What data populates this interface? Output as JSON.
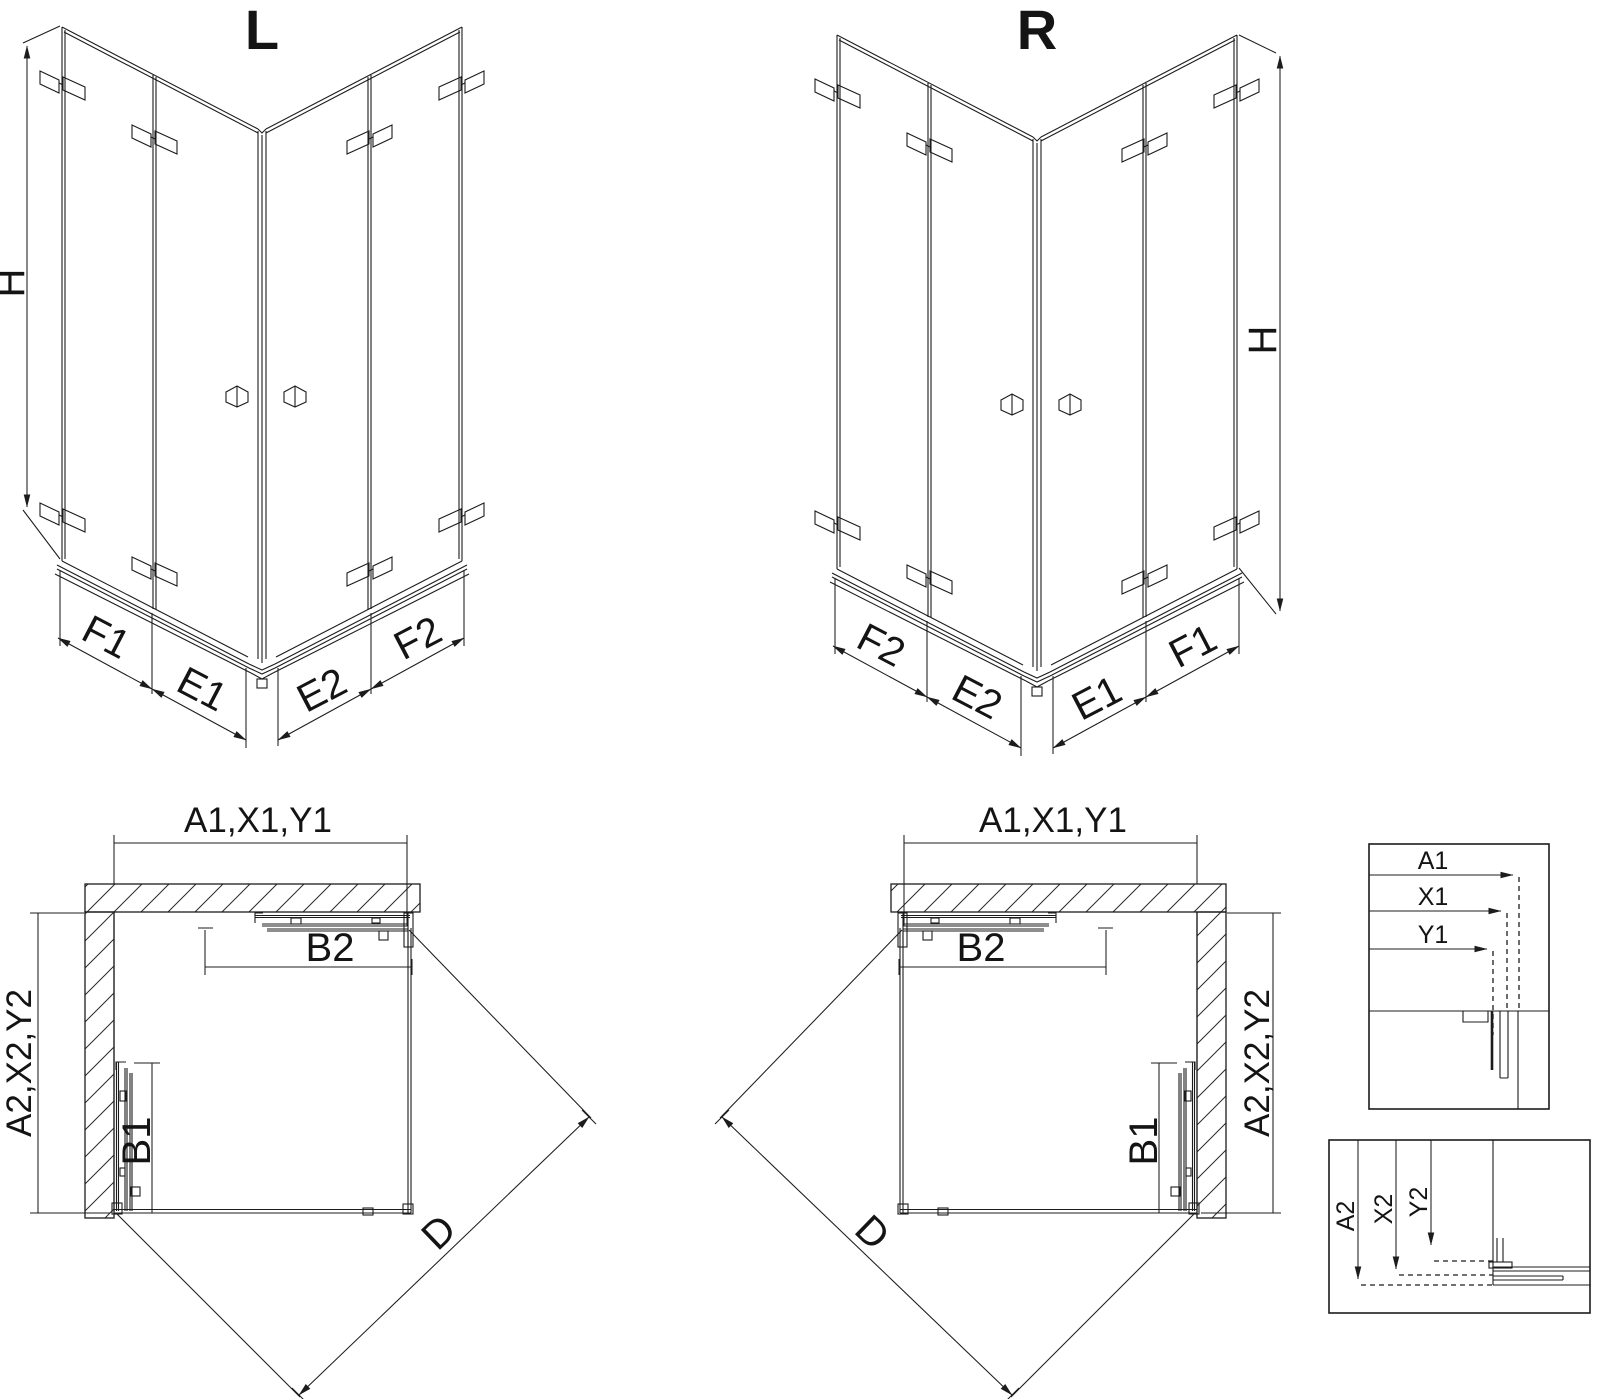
{
  "drawing": {
    "iso_left": {
      "title": "L",
      "height": "H",
      "bottom": [
        "F1",
        "E1",
        "E2",
        "F2"
      ]
    },
    "iso_right": {
      "title": "R",
      "height": "H",
      "bottom": [
        "F2",
        "E2",
        "E1",
        "F1"
      ]
    },
    "plan_left": {
      "width": "A1,X1,Y1",
      "depth": "A2,X2,Y2",
      "door_top": "B2",
      "door_side": "B1",
      "diagonal": "D"
    },
    "plan_right": {
      "width": "A1,X1,Y1",
      "depth": "A2,X2,Y2",
      "door_top": "B2",
      "door_side": "B1",
      "diagonal": "D"
    },
    "detail_horizontal": {
      "dims": [
        "A1",
        "X1",
        "Y1"
      ]
    },
    "detail_vertical": {
      "dims": [
        "A2",
        "X2",
        "Y2"
      ]
    }
  },
  "colors": {
    "line": "#1c1c1c",
    "background": "#ffffff"
  }
}
